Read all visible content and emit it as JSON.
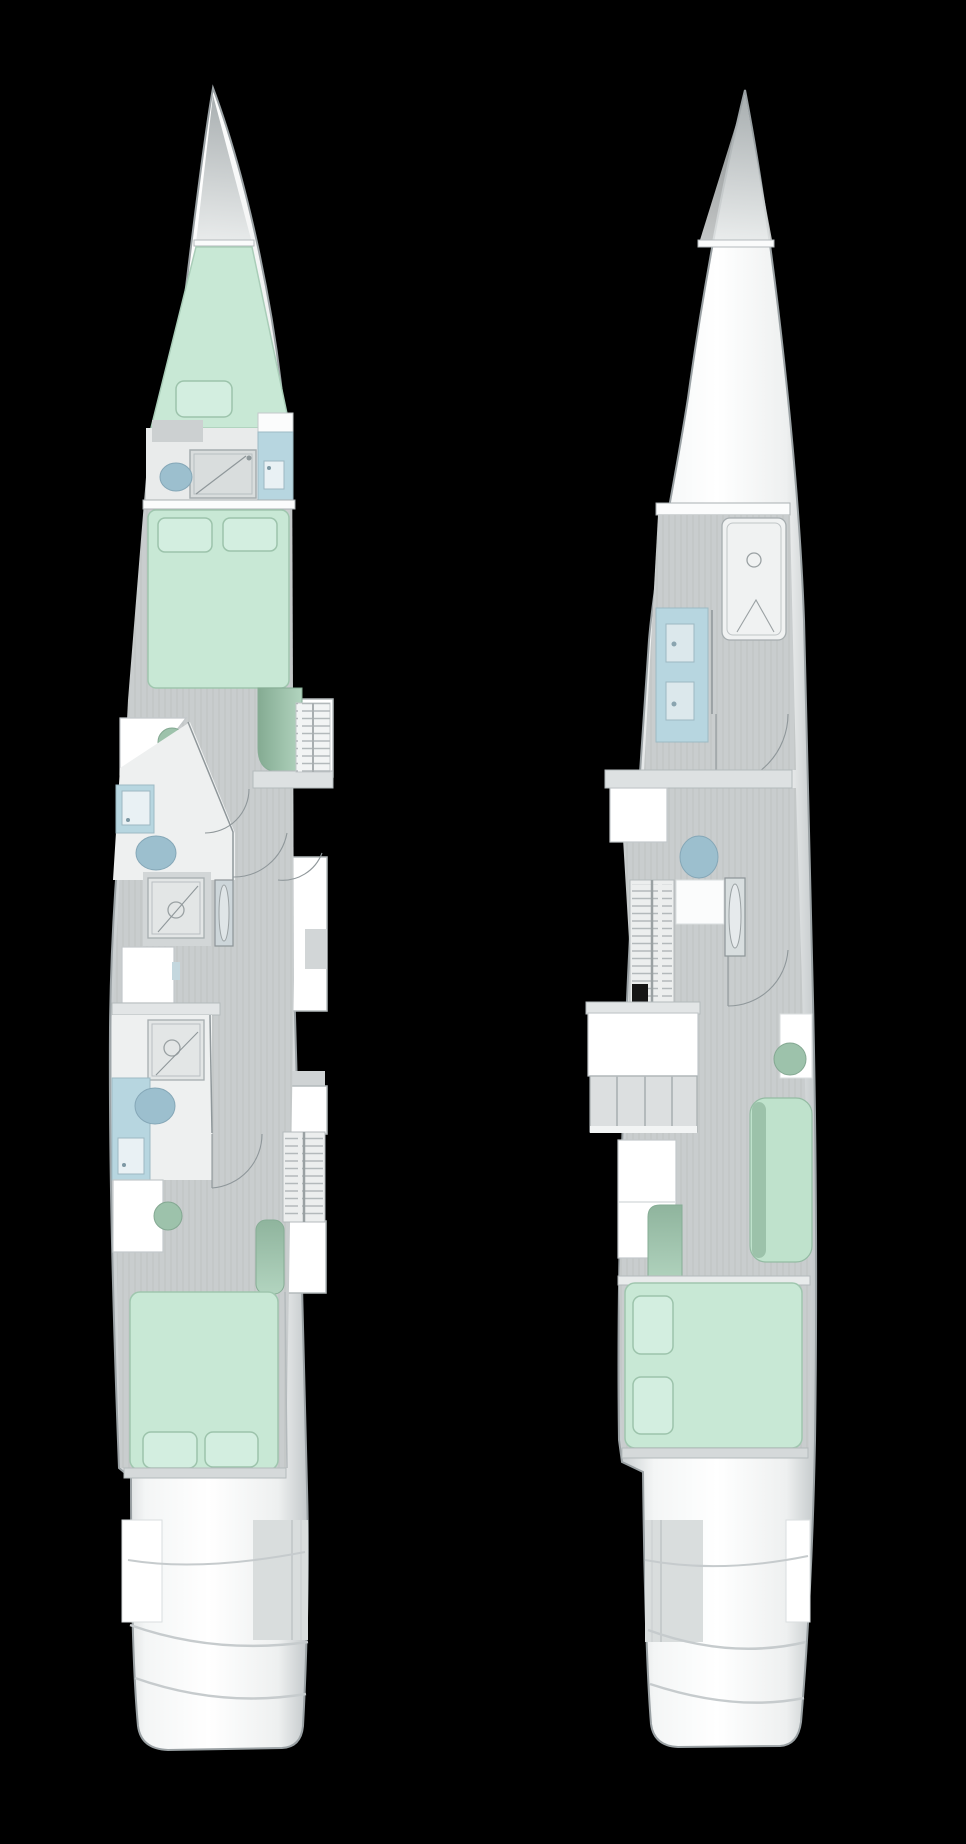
{
  "scene": {
    "type": "yacht-floor-plan",
    "description": "top-down deck plan of a catamaran sailing yacht, two hulls side by side",
    "background_color": "#000000",
    "text_labels": []
  },
  "palette": {
    "background": "#000000",
    "hull_white": "#ffffff",
    "hull_edge": "#9aa1a4",
    "bow_shade": "#b2b8ba",
    "floor_gray": "#c9cdce",
    "floor_light": "#eceeee",
    "wall_line": "#8f979a",
    "band_gray": "#e2e5e6",
    "stair_gray": "#dcdfe0",
    "mint_bed": "#c8e8d5",
    "mint_pillow": "#d3eee0",
    "mint_stroke": "#9cc3ab",
    "sage_seat": "#9dc2ab",
    "sage_dark": "#86ad95",
    "blue_counter": "#b7d6e0",
    "blue_fixture": "#9cbfce",
    "sink_white": "#e9f1f4",
    "ladder_black": "#161616"
  },
  "hulls": [
    {
      "id": "hull-port",
      "position": "left",
      "bow": "top",
      "rooms": [
        "bow-locker",
        "v-berth-cabin",
        "forward-head",
        "forward-double-cabin",
        "mid-head-with-shower",
        "aft-head-with-shower",
        "aft-double-cabin",
        "transom-steps"
      ],
      "furniture": [
        "v-berth-cushion",
        "toilet",
        "shower-pan",
        "vanity-sink",
        "double-bed",
        "bed-pillow",
        "bed-pillow",
        "reading-chaise",
        "companionway-stairs",
        "desk",
        "round-stool",
        "walk-in-shower",
        "mirror-cabinet",
        "storage-cabinet",
        "ladder-stairs",
        "aft-chaise",
        "aft-double-bed",
        "bed-pillow",
        "bed-pillow"
      ],
      "fixture_counts": {
        "toilets": 3,
        "sinks": 3,
        "showers": 3,
        "beds": 2,
        "stairs": 3
      }
    },
    {
      "id": "hull-starboard",
      "position": "right",
      "bow": "top",
      "rooms": [
        "bow-locker",
        "forward-shower-room",
        "vanity-area",
        "owner-stateroom",
        "transom-steps"
      ],
      "furniture": [
        "walk-in-shower",
        "double-sink-vanity",
        "forward-desk",
        "toilet",
        "ladder-stairs",
        "wardrobe-mirror",
        "galley-cabinet",
        "companionway-stairs",
        "lower-cabinet",
        "side-desk",
        "round-stool",
        "chaise-longue",
        "bed-headboard",
        "island-bed",
        "bed-pillow",
        "bed-pillow"
      ],
      "fixture_counts": {
        "toilets": 1,
        "sinks": 2,
        "showers": 1,
        "beds": 1,
        "stairs": 2
      }
    }
  ]
}
